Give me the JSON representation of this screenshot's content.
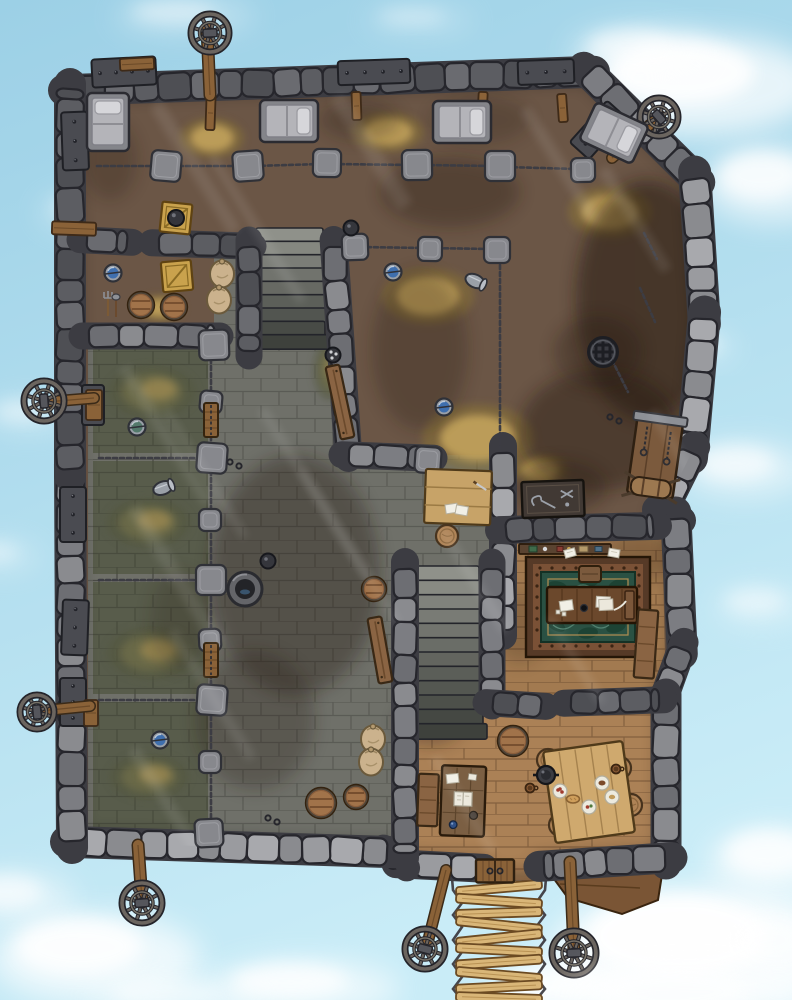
{
  "scene": {
    "description": "Top-down fantasy battle map of a floating sky-prison fortress surrounded by blue sky and clouds",
    "style": "hand-drawn RPG battle map",
    "features": [
      "stone perimeter walls",
      "prisoner barracks with beds",
      "chain fences with stone posts",
      "four prison cells with straw floors",
      "stone courtyard",
      "two staircases",
      "interrogation room with floor drain and torture rack",
      "warden office with ornate rug and desk",
      "guard mess room with dining table",
      "storage corner with crates, barrels and sacks",
      "seven wagon wheels on wooden poles",
      "rope bridge exit with wooden planks",
      "riveted iron wall plates"
    ]
  },
  "palette": {
    "sky_top": "#9cd0e6",
    "sky_bottom": "#c9ecf7",
    "cloud": "#ffffff",
    "dirt_floor": "#6b5646",
    "stone_floor": "#6f7069",
    "cell_floor": "#585c4b",
    "wood_floor": "#a27a50",
    "wood_floor_light": "#ab8156",
    "wood_beam": "#7a5535",
    "wall_light": "#9a9b9f",
    "wall_mid": "#7c7d82",
    "wall_dark": "#5c5d62",
    "wall_outline": "#26262c",
    "chain": "#3c3c43",
    "hay": "#c2a35c",
    "moss": "#6e6d4a",
    "water_blue": "#3f6fae",
    "rug_green": "#2a5143",
    "rug_border": "#563a27",
    "plank_light": "#d9b678",
    "metal_plate": "#4a4b51"
  },
  "clouds": [
    [
      700,
      85,
      120,
      50,
      0.9
    ],
    [
      772,
      185,
      70,
      38,
      0.75
    ],
    [
      640,
      52,
      70,
      26,
      0.55
    ],
    [
      95,
      212,
      55,
      20,
      0.4
    ],
    [
      28,
      415,
      45,
      16,
      0.4
    ],
    [
      708,
      347,
      26,
      11,
      0.55
    ],
    [
      745,
      470,
      65,
      28,
      0.6
    ],
    [
      700,
      952,
      150,
      65,
      0.95
    ],
    [
      778,
      862,
      70,
      36,
      0.75
    ],
    [
      95,
      958,
      105,
      45,
      0.85
    ],
    [
      15,
      898,
      60,
      26,
      0.6
    ],
    [
      305,
      988,
      95,
      28,
      0.75
    ],
    [
      185,
      16,
      70,
      18,
      0.4
    ],
    [
      565,
      992,
      80,
      30,
      0.8
    ],
    [
      762,
      606,
      48,
      20,
      0.4
    ],
    [
      0,
      556,
      40,
      16,
      0.35
    ],
    [
      420,
      20,
      55,
      14,
      0.3
    ]
  ],
  "top_clouds": [
    [
      690,
      1002,
      130,
      42,
      0.6
    ],
    [
      180,
      1000,
      90,
      24,
      0.45
    ],
    [
      779,
      950,
      62,
      40,
      0.5
    ]
  ],
  "walls": {
    "outer": [
      [
        70,
        90,
        588,
        72,
        27,
        "dark"
      ],
      [
        588,
        72,
        695,
        178,
        27,
        "mid"
      ],
      [
        695,
        178,
        704,
        318,
        28,
        "light"
      ],
      [
        704,
        318,
        692,
        452,
        28,
        "light"
      ],
      [
        692,
        452,
        662,
        512,
        26,
        "light"
      ],
      [
        662,
        512,
        676,
        518,
        24,
        "mid"
      ],
      [
        676,
        518,
        682,
        648,
        26,
        "mid"
      ],
      [
        682,
        648,
        664,
        698,
        24,
        "mid"
      ],
      [
        666,
        700,
        666,
        858,
        26,
        "mid"
      ],
      [
        666,
        858,
        545,
        866,
        26,
        "mid"
      ],
      [
        478,
        868,
        402,
        864,
        24,
        "light"
      ],
      [
        402,
        864,
        388,
        852,
        22,
        "light"
      ],
      [
        388,
        852,
        72,
        842,
        27,
        "light"
      ],
      [
        72,
        842,
        70,
        470,
        27,
        "mid"
      ],
      [
        70,
        470,
        70,
        90,
        27,
        "dark"
      ]
    ],
    "inner": [
      [
        86,
        240,
        126,
        242,
        22,
        "dark"
      ],
      [
        158,
        243,
        247,
        246,
        22,
        "dark"
      ],
      [
        249,
        246,
        249,
        350,
        22,
        "dark"
      ],
      [
        334,
        246,
        348,
        452,
        23,
        "mid"
      ],
      [
        348,
        455,
        428,
        458,
        22,
        "mid"
      ],
      [
        503,
        452,
        503,
        630,
        23,
        "light"
      ],
      [
        505,
        530,
        652,
        526,
        23,
        "dark"
      ],
      [
        405,
        568,
        405,
        852,
        23,
        "mid"
      ],
      [
        492,
        568,
        492,
        700,
        22,
        "mid"
      ],
      [
        492,
        703,
        540,
        706,
        22,
        "dark"
      ],
      [
        570,
        703,
        658,
        700,
        22,
        "dark"
      ],
      [
        88,
        336,
        214,
        336,
        22,
        "mid"
      ]
    ]
  },
  "posts": [
    [
      166,
      166,
      30
    ],
    [
      248,
      166,
      30
    ],
    [
      327,
      163,
      28
    ],
    [
      417,
      165,
      30
    ],
    [
      500,
      166,
      30
    ],
    [
      355,
      247,
      26
    ],
    [
      430,
      249,
      24
    ],
    [
      497,
      250,
      26
    ],
    [
      214,
      345,
      30
    ],
    [
      211,
      402,
      22
    ],
    [
      212,
      458,
      30
    ],
    [
      210,
      520,
      22
    ],
    [
      211,
      580,
      30
    ],
    [
      210,
      640,
      22
    ],
    [
      212,
      700,
      30
    ],
    [
      210,
      762,
      22
    ],
    [
      209,
      833,
      28
    ],
    [
      428,
      460,
      26
    ],
    [
      583,
      170,
      24
    ]
  ],
  "chains": [
    [
      97,
      166,
      160,
      166
    ],
    [
      172,
      166,
      242,
      166
    ],
    [
      254,
      166,
      321,
      164
    ],
    [
      333,
      164,
      411,
      165
    ],
    [
      423,
      165,
      494,
      166
    ],
    [
      506,
      167,
      577,
      169
    ],
    [
      500,
      258,
      500,
      448
    ],
    [
      360,
      247,
      492,
      249
    ],
    [
      211,
      352,
      211,
      828
    ],
    [
      99,
      458,
      205,
      458
    ],
    [
      99,
      580,
      205,
      580
    ],
    [
      99,
      700,
      205,
      700
    ],
    [
      640,
      288,
      655,
      322
    ],
    [
      612,
      360,
      628,
      392
    ],
    [
      644,
      233,
      657,
      259
    ]
  ],
  "wheels": [
    {
      "x": 210,
      "y": 33,
      "r": 21,
      "pole": [
        210,
        95,
        207,
        28,
        10
      ]
    },
    {
      "x": 659,
      "y": 117,
      "r": 21,
      "pole": [
        612,
        158,
        660,
        116,
        9
      ]
    },
    {
      "x": 44,
      "y": 401,
      "r": 22,
      "pole": [
        94,
        398,
        46,
        402,
        9
      ]
    },
    {
      "x": 37,
      "y": 712,
      "r": 19,
      "pole": [
        90,
        706,
        40,
        711,
        9
      ]
    },
    {
      "x": 142,
      "y": 903,
      "r": 22,
      "pole": [
        138,
        845,
        142,
        900,
        10
      ]
    },
    {
      "x": 425,
      "y": 949,
      "r": 22,
      "pole": [
        446,
        870,
        427,
        945,
        9
      ]
    },
    {
      "x": 574,
      "y": 953,
      "r": 24,
      "pole": [
        570,
        862,
        574,
        950,
        10
      ]
    }
  ],
  "metal_plates": [
    [
      62,
      112,
      26,
      58,
      -2
    ],
    [
      60,
      487,
      26,
      55,
      0
    ],
    [
      62,
      600,
      26,
      55,
      2
    ],
    [
      92,
      58,
      64,
      28,
      -3
    ],
    [
      338,
      60,
      72,
      24,
      -2
    ],
    [
      518,
      60,
      56,
      24,
      -2
    ],
    [
      585,
      102,
      26,
      56,
      42
    ],
    [
      60,
      678,
      26,
      48,
      0
    ],
    [
      82,
      385,
      22,
      40,
      0
    ]
  ],
  "wood_beams": [
    [
      206,
      96,
      9,
      34,
      2
    ],
    [
      352,
      92,
      9,
      28,
      -2
    ],
    [
      478,
      92,
      9,
      28,
      3
    ],
    [
      558,
      94,
      9,
      28,
      -4
    ],
    [
      52,
      222,
      44,
      13,
      2
    ],
    [
      86,
      390,
      16,
      30,
      0
    ],
    [
      84,
      700,
      14,
      26,
      0
    ],
    [
      120,
      58,
      34,
      12,
      -3
    ]
  ],
  "stairs": [
    {
      "x": 258,
      "y": 228,
      "w": 70,
      "h": 120,
      "n": 9
    },
    {
      "x": 416,
      "y": 566,
      "w": 68,
      "h": 172,
      "n": 12
    }
  ],
  "patches": [
    [
      212,
      138,
      32,
      20,
      "hay"
    ],
    [
      388,
      132,
      36,
      20,
      "hay"
    ],
    [
      610,
      212,
      42,
      26,
      "hay"
    ],
    [
      428,
      296,
      46,
      28,
      "hay"
    ],
    [
      478,
      438,
      56,
      34,
      "hay"
    ],
    [
      160,
      308,
      24,
      13,
      "hay"
    ],
    [
      152,
      392,
      44,
      26,
      "moss"
    ],
    [
      148,
      523,
      42,
      24,
      "moss"
    ],
    [
      151,
      653,
      44,
      26,
      "moss"
    ],
    [
      149,
      777,
      40,
      22,
      "moss"
    ],
    [
      540,
      470,
      28,
      16,
      "hay"
    ],
    [
      330,
      370,
      16,
      30,
      "moss"
    ]
  ],
  "stains": [
    [
      648,
      300,
      72,
      120,
      0.5
    ],
    [
      600,
      430,
      80,
      60,
      0.4
    ],
    [
      450,
      192,
      70,
      35,
      0.3
    ],
    [
      360,
      120,
      40,
      20,
      0.25
    ],
    [
      295,
      575,
      85,
      120,
      0.34
    ],
    [
      255,
      720,
      60,
      70,
      0.26
    ],
    [
      420,
      350,
      48,
      80,
      0.25
    ],
    [
      560,
      487,
      46,
      26,
      0.32
    ],
    [
      430,
      722,
      34,
      24,
      0.3
    ],
    [
      640,
      556,
      36,
      24,
      0.22
    ],
    [
      300,
      300,
      40,
      30,
      0.2
    ],
    [
      110,
      160,
      28,
      40,
      0.22
    ],
    [
      598,
      352,
      44,
      36,
      0.3
    ],
    [
      520,
      628,
      26,
      36,
      0.2
    ],
    [
      180,
      620,
      30,
      50,
      0.18
    ],
    [
      480,
      120,
      50,
      24,
      0.2
    ]
  ],
  "light_shafts": [
    [
      150,
      108,
      14,
      150
    ],
    [
      208,
      160,
      10,
      170
    ],
    [
      330,
      100,
      16,
      130
    ],
    [
      520,
      112,
      12,
      130
    ],
    [
      118,
      370,
      12,
      160
    ],
    [
      162,
      412,
      8,
      150
    ],
    [
      128,
      512,
      14,
      160
    ],
    [
      168,
      634,
      10,
      150
    ],
    [
      128,
      752,
      12,
      140
    ],
    [
      258,
      412,
      10,
      200
    ],
    [
      298,
      472,
      8,
      180
    ],
    [
      438,
      532,
      10,
      120
    ],
    [
      598,
      172,
      12,
      120
    ],
    [
      648,
      414,
      10,
      90
    ],
    [
      545,
      620,
      9,
      100
    ],
    [
      430,
      760,
      10,
      110
    ]
  ],
  "bridge": {
    "cx": 499,
    "left": 452,
    "right": 546,
    "top": 878,
    "width": 86,
    "thick": 9,
    "planks": [
      [
        888,
        -5
      ],
      [
        901,
        4
      ],
      [
        913,
        -2
      ],
      [
        925,
        6
      ],
      [
        938,
        -6
      ],
      [
        950,
        3
      ],
      [
        962,
        -4
      ],
      [
        975,
        5
      ],
      [
        987,
        -3
      ],
      [
        998,
        2
      ]
    ]
  },
  "objects": [
    {
      "t": "bed",
      "x": 108,
      "y": 122,
      "r": 0
    },
    {
      "t": "bed",
      "x": 289,
      "y": 121,
      "r": 90
    },
    {
      "t": "bed",
      "x": 462,
      "y": 122,
      "r": 90
    },
    {
      "t": "bed",
      "x": 614,
      "y": 133,
      "r": 115
    },
    {
      "t": "crate",
      "x": 176,
      "y": 218,
      "r": 6,
      "v": "pot"
    },
    {
      "t": "crate",
      "x": 177,
      "y": 276,
      "r": -5
    },
    {
      "t": "bucket",
      "x": 113,
      "y": 273,
      "v": "blue"
    },
    {
      "t": "tools",
      "x": 110,
      "y": 306
    },
    {
      "t": "barrel",
      "x": 141,
      "y": 305,
      "s": 13
    },
    {
      "t": "barrel",
      "x": 174,
      "y": 307,
      "s": 13
    },
    {
      "t": "sack",
      "x": 222,
      "y": 274
    },
    {
      "t": "sack",
      "x": 219,
      "y": 300
    },
    {
      "t": "pot",
      "x": 351,
      "y": 228
    },
    {
      "t": "pot",
      "x": 333,
      "y": 355,
      "v": "dots"
    },
    {
      "t": "bucket",
      "x": 393,
      "y": 272,
      "v": "blue"
    },
    {
      "t": "bucket",
      "x": 475,
      "y": 281,
      "v": "tip",
      "r": 25
    },
    {
      "t": "bucket",
      "x": 444,
      "y": 407,
      "v": "blue"
    },
    {
      "t": "drain",
      "x": 603,
      "y": 352
    },
    {
      "t": "rack",
      "x": 655,
      "y": 458,
      "r": 8
    },
    {
      "t": "toolTable",
      "x": 553,
      "y": 499,
      "r": -2
    },
    {
      "t": "tableLight",
      "x": 458,
      "y": 497,
      "r": 2
    },
    {
      "t": "stool",
      "x": 447,
      "y": 536
    },
    {
      "t": "plank",
      "x": 340,
      "y": 402,
      "r": 78,
      "l": 74
    },
    {
      "t": "plank",
      "x": 380,
      "y": 650,
      "r": 80,
      "l": 66
    },
    {
      "t": "well",
      "x": 245,
      "y": 589
    },
    {
      "t": "pot",
      "x": 268,
      "y": 561
    },
    {
      "t": "barrel",
      "x": 374,
      "y": 589,
      "s": 12
    },
    {
      "t": "cellDoor",
      "x": 211,
      "y": 420
    },
    {
      "t": "cellDoor",
      "x": 211,
      "y": 660
    },
    {
      "t": "bucket",
      "x": 137,
      "y": 427,
      "v": "green"
    },
    {
      "t": "bucket",
      "x": 163,
      "y": 488,
      "v": "tip",
      "r": -20
    },
    {
      "t": "bucket",
      "x": 160,
      "y": 740,
      "v": "blue"
    },
    {
      "t": "sack",
      "x": 373,
      "y": 739
    },
    {
      "t": "sack",
      "x": 371,
      "y": 762
    },
    {
      "t": "barrel",
      "x": 321,
      "y": 803,
      "s": 15
    },
    {
      "t": "barrel",
      "x": 356,
      "y": 797,
      "s": 12
    },
    {
      "t": "ringpair",
      "x": 230,
      "y": 462
    },
    {
      "t": "ringpair",
      "x": 268,
      "y": 818
    },
    {
      "t": "ringpair",
      "x": 610,
      "y": 417
    },
    {
      "t": "rug",
      "x": 588,
      "y": 607
    },
    {
      "t": "deskOffice",
      "x": 592,
      "y": 605
    },
    {
      "t": "stoolSq",
      "x": 590,
      "y": 574
    },
    {
      "t": "shelf",
      "x": 565,
      "y": 549
    },
    {
      "t": "paper",
      "x": 570,
      "y": 553,
      "r": -15
    },
    {
      "t": "paper",
      "x": 614,
      "y": 553,
      "r": 10
    },
    {
      "t": "benchv",
      "x": 646,
      "y": 644,
      "r": 4,
      "l": 68
    },
    {
      "t": "barrel",
      "x": 513,
      "y": 741,
      "s": 15
    },
    {
      "t": "deskGuard",
      "x": 463,
      "y": 801,
      "r": 2
    },
    {
      "t": "benchv",
      "x": 428,
      "y": 800,
      "r": 2,
      "l": 52
    },
    {
      "t": "stool",
      "x": 548,
      "y": 760
    },
    {
      "t": "stool",
      "x": 620,
      "y": 768
    },
    {
      "t": "stool",
      "x": 631,
      "y": 805
    },
    {
      "t": "stool",
      "x": 560,
      "y": 825
    },
    {
      "t": "bigTable",
      "x": 589,
      "y": 792,
      "r": -8
    },
    {
      "t": "potHandled",
      "x": 546,
      "y": 775
    },
    {
      "t": "plate",
      "x": 560,
      "y": 791,
      "v": "red"
    },
    {
      "t": "plate",
      "x": 602,
      "y": 783,
      "v": "brown"
    },
    {
      "t": "plate",
      "x": 589,
      "y": 807,
      "v": "mix"
    },
    {
      "t": "plate",
      "x": 612,
      "y": 797,
      "v": "tan"
    },
    {
      "t": "mug",
      "x": 530,
      "y": 788
    },
    {
      "t": "mug",
      "x": 616,
      "y": 769
    },
    {
      "t": "bread",
      "x": 573,
      "y": 799
    },
    {
      "t": "door",
      "x": 495,
      "y": 871
    }
  ]
}
